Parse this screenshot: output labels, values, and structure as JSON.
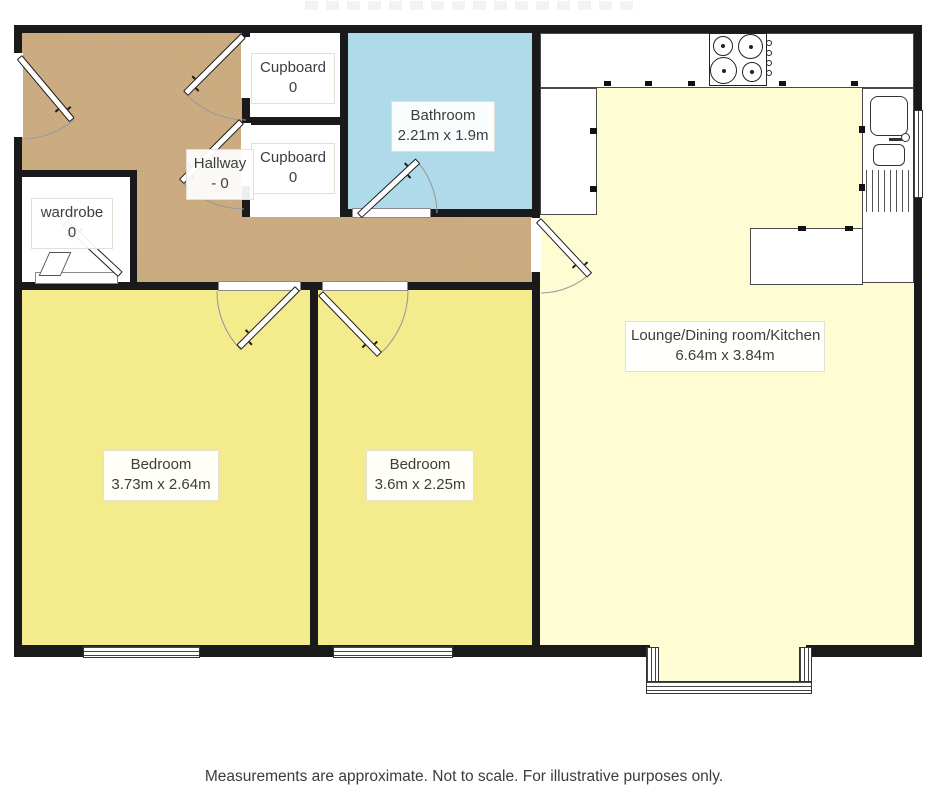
{
  "rooms": {
    "hallway": {
      "label": "Hallway",
      "size": "- 0"
    },
    "wardrobe": {
      "label": "wardrobe",
      "size": "0"
    },
    "cupboard_top": {
      "label": "Cupboard",
      "size": "0"
    },
    "cupboard_bottom": {
      "label": "Cupboard",
      "size": "0"
    },
    "bathroom": {
      "label": "Bathroom",
      "size": "2.21m x 1.9m"
    },
    "bedroom_left": {
      "label": "Bedroom",
      "size": "3.73m x 2.64m"
    },
    "bedroom_center": {
      "label": "Bedroom",
      "size": "3.6m x 2.25m"
    },
    "lounge_kitchen": {
      "label": "Lounge/Dining room/Kitchen",
      "size": "6.64m x 3.84m"
    }
  },
  "footer": {
    "disclaimer": "Measurements are approximate. Not to scale. For illustrative purposes only."
  },
  "fixtures": [
    "hob-icon",
    "sink-icon",
    "drainer-icon",
    "kitchen-counter",
    "island-counter",
    "door-leaf",
    "door-swing-arc",
    "window"
  ],
  "colors": {
    "wall": "#1A1A1A",
    "hallway": "#C9A87C",
    "bedroom": "#F4EC8C",
    "lounge": "#FDFCD3",
    "bathroom": "#AEDAEA",
    "outline": "#4A4A4A",
    "text": "#3D3D3D"
  }
}
